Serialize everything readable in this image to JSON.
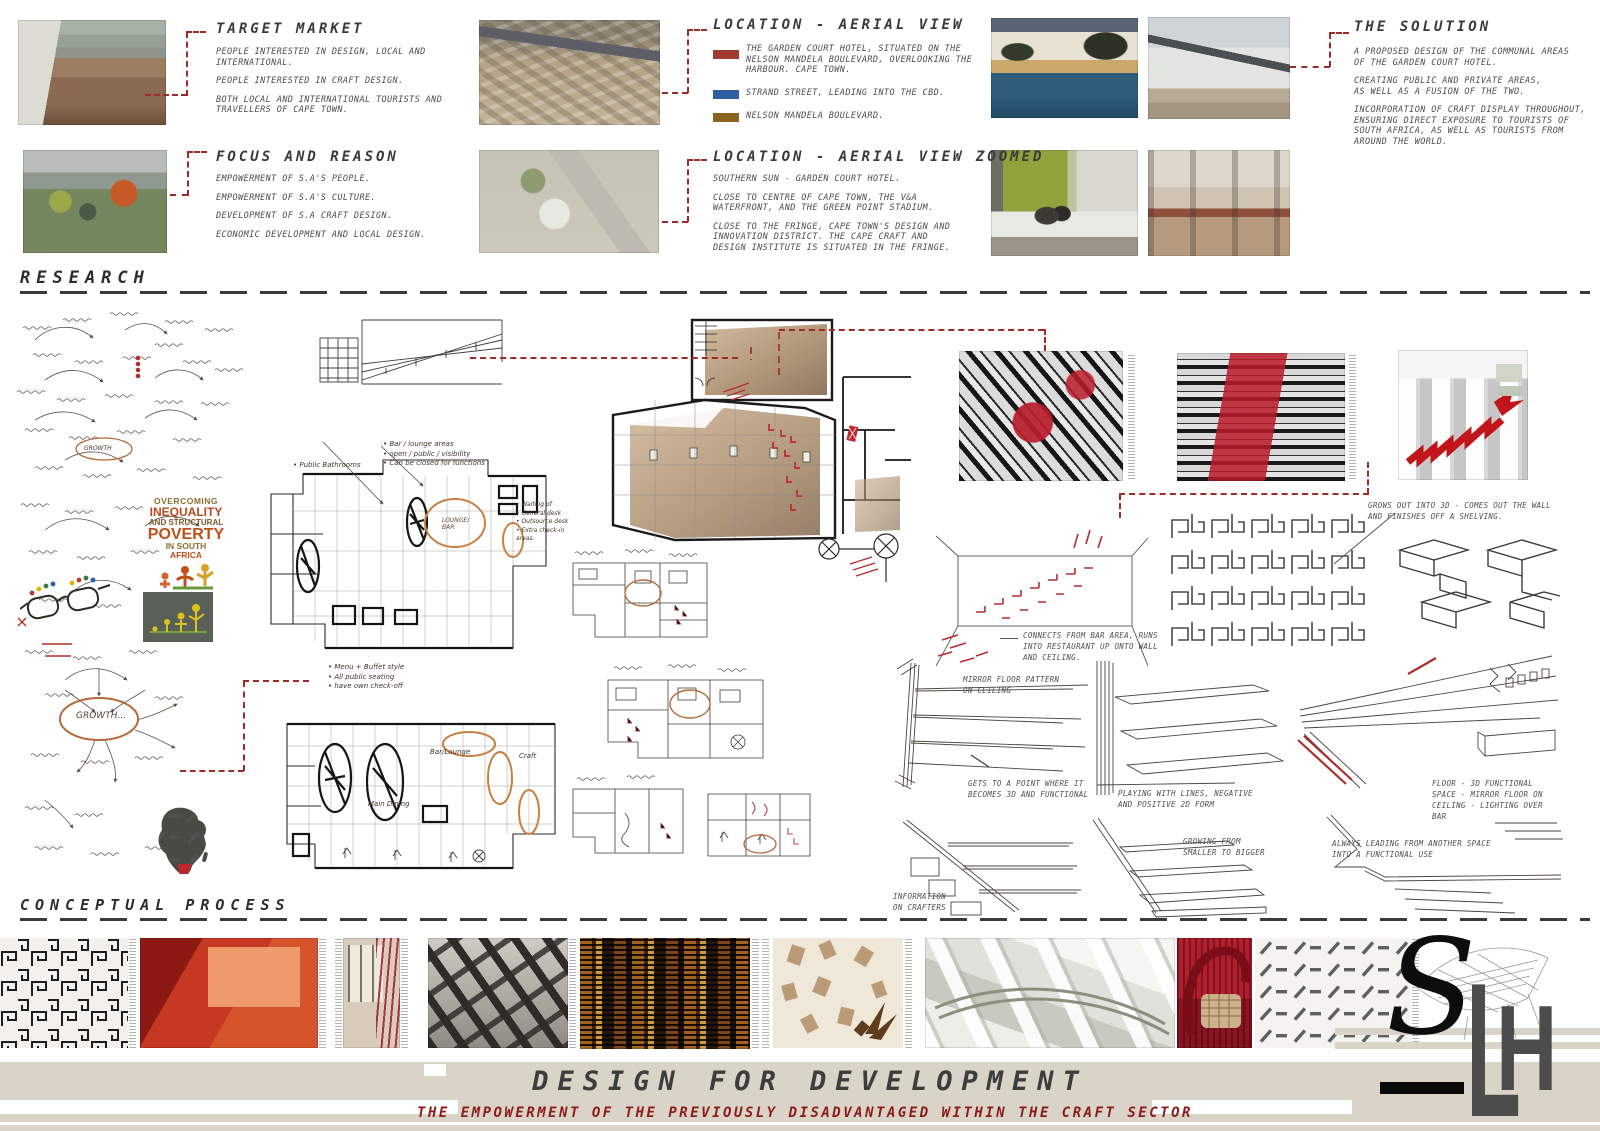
{
  "headings": {
    "research": "RESEARCH",
    "conceptual": "CONCEPTUAL PROCESS"
  },
  "target_market": {
    "title": "TARGET MARKET",
    "lines": [
      "PEOPLE INTERESTED IN DESIGN, LOCAL AND",
      "INTERNATIONAL.",
      "",
      "PEOPLE INTERESTED IN CRAFT DESIGN.",
      "",
      "BOTH LOCAL AND INTERNATIONAL TOURISTS AND",
      "TRAVELLERS OF CAPE TOWN."
    ]
  },
  "focus_reason": {
    "title": "FOCUS AND REASON",
    "lines": [
      "EMPOWERMENT OF S.A'S PEOPLE.",
      "",
      "EMPOWERMENT OF S.A'S CULTURE.",
      "",
      "DEVELOPMENT OF S.A CRAFT DESIGN.",
      "",
      "ECONOMIC DEVELOPMENT AND LOCAL DESIGN."
    ]
  },
  "location_aerial": {
    "title": "LOCATION - AERIAL VIEW",
    "legend": [
      {
        "color": "#a33a31",
        "lines": [
          "THE GARDEN COURT HOTEL, SITUATED ON THE",
          "NELSON MANDELA BOULEVARD, OVERLOOKING THE",
          "HARBOUR.  CAPE TOWN."
        ]
      },
      {
        "color": "#2e5fa3",
        "lines": [
          "STRAND STREET, LEADING INTO THE CBD."
        ]
      },
      {
        "color": "#8a6520",
        "lines": [
          "NELSON MANDELA BOULEVARD."
        ]
      }
    ]
  },
  "location_zoomed": {
    "title": "LOCATION - AERIAL VIEW ZOOMED",
    "lines": [
      "SOUTHERN SUN - GARDEN COURT HOTEL.",
      "",
      "CLOSE TO CENTRE OF CAPE TOWN, THE V&A",
      "WATERFRONT, AND THE GREEN POINT STADIUM.",
      "",
      "CLOSE TO THE FRINGE, CAPE TOWN'S DESIGN AND",
      "INNOVATION DISTRICT.  THE CAPE CRAFT AND",
      "DESIGN INSTITUTE IS SITUATED IN THE FRINGE."
    ]
  },
  "solution": {
    "title": "THE SOLUTION",
    "lines": [
      "A PROPOSED DESIGN OF THE COMMUNAL AREAS",
      "OF THE GARDEN COURT HOTEL.",
      "",
      "CREATING PUBLIC AND PRIVATE AREAS,",
      "AS WELL AS A FUSION OF THE TWO.",
      "",
      "INCORPORATION OF CRAFT DISPLAY THROUGHOUT,",
      "ENSURING DIRECT EXPOSURE TO TOURISTS OF",
      "SOUTH AFRICA, AS WELL AS TOURISTS FROM",
      "AROUND THE WORLD."
    ]
  },
  "research_notes": {
    "grows_out": [
      "GROWS OUT INTO 3D - COMES OUT THE WALL",
      "AND FINISHES OFF A SHELVING."
    ],
    "connects": [
      "CONNECTS FROM BAR AREA, RUNS",
      "INTO RESTAURANT UP ONTO WALL",
      "AND CEILING."
    ],
    "mirror_floor": [
      "MIRROR FLOOR PATTERN",
      "ON CEILING"
    ],
    "gets_point": [
      "GETS TO A POINT WHERE IT",
      "BECOMES 3D AND FUNCTIONAL"
    ],
    "playing_lines": [
      "PLAYING WITH LINES, NEGATIVE",
      "AND POSITIVE 2D FORM"
    ],
    "floor_3d": [
      "FLOOR - 3D FUNCTIONAL",
      "SPACE - MIRROR FLOOR ON",
      "CEILING - LIGHTING OVER",
      "BAR"
    ],
    "info_crafters": [
      "INFORMATION",
      "ON CRAFTERS"
    ],
    "growing": [
      "GROWING FROM",
      "SMALLER TO BIGGER"
    ],
    "always_leading": [
      "ALWAYS LEADING FROM ANOTHER SPACE",
      "INTO A FUNCTIONAL USE"
    ]
  },
  "hand_notes": {
    "bar_lounge": [
      "• Bar / lounge areas",
      "• open / public / visibility",
      "• Can be closed for functions"
    ],
    "public_bathrooms": "• Public Bathrooms",
    "waiting": [
      "• Waiting of",
      "• General desk",
      "• Outsource desk",
      "• Extra check-in",
      "   areas."
    ],
    "menu_buffet": [
      "• Menu + Buffet style",
      "• All public seating",
      "• have own check-off"
    ],
    "lounge_bar": [
      "LOUNGE/",
      "BAR"
    ],
    "main_dining": "Main Dining",
    "bar_lounge_label": "Bar/Lounge",
    "craft": "Craft",
    "growth": "GROWTH...",
    "growth_small": "GROWTH"
  },
  "poster": {
    "l1": "OVERCOMING",
    "l2": "INEQUALITY",
    "l3": "AND STRUCTURAL",
    "l4": "POVERTY",
    "l5": "IN SOUTH",
    "l6": "AFRICA"
  },
  "footer": {
    "title": "DESIGN FOR DEVELOPMENT",
    "subtitle": "THE EMPOWERMENT OF THE PREVIOUSLY DISADVANTAGED WITHIN THE CRAFT SECTOR"
  },
  "logo": {
    "s": "S",
    "l": "L",
    "h": "H"
  },
  "colors": {
    "accent_red": "#9e2b25",
    "legend_red": "#a33a31",
    "legend_blue": "#2e5fa3",
    "legend_brown": "#8a6520",
    "footer_bg": "#d9d4c7",
    "subtitle_red": "#8e1b1c",
    "title_gray": "#3d3d3d",
    "highlight_orange": "#c87f3f"
  }
}
